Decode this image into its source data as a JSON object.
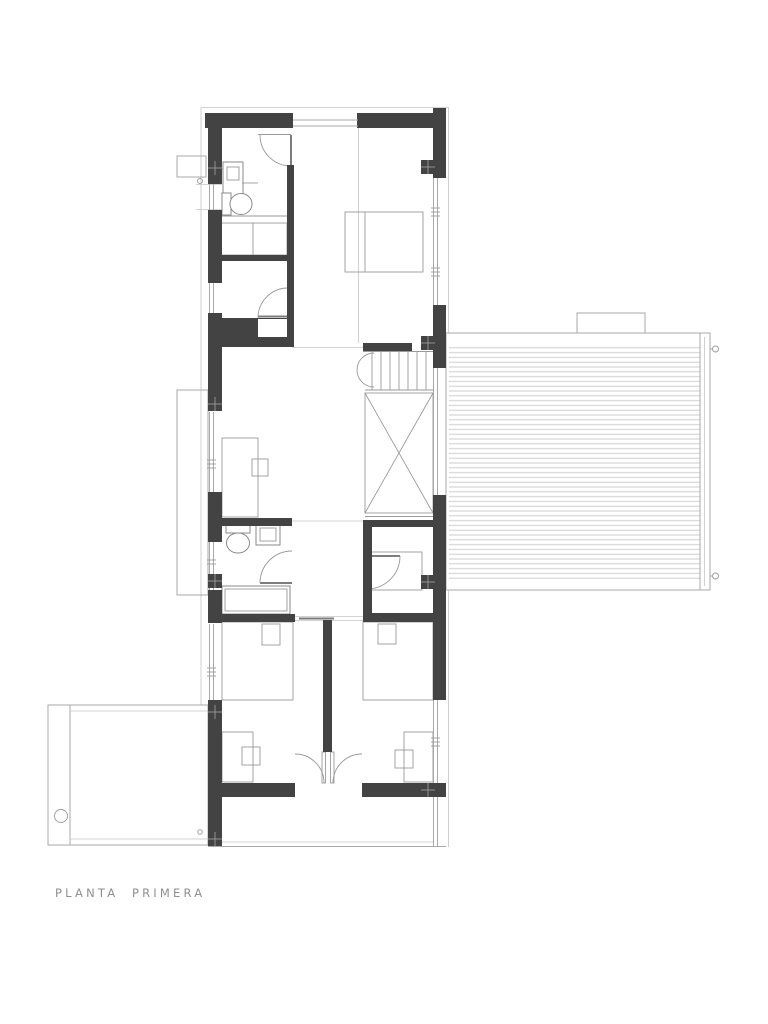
{
  "drawing": {
    "label": "PLANTA  PRIMERA",
    "type_note": "architectural first-floor plan",
    "colors": {
      "background": "#ffffff",
      "wall_poche": "#434343",
      "thin_line": "#a9a9a9",
      "fixture_line": "#8a8a8a",
      "deck_hatch": "#c9c9c9",
      "caption_text": "#8f8f8f"
    }
  }
}
